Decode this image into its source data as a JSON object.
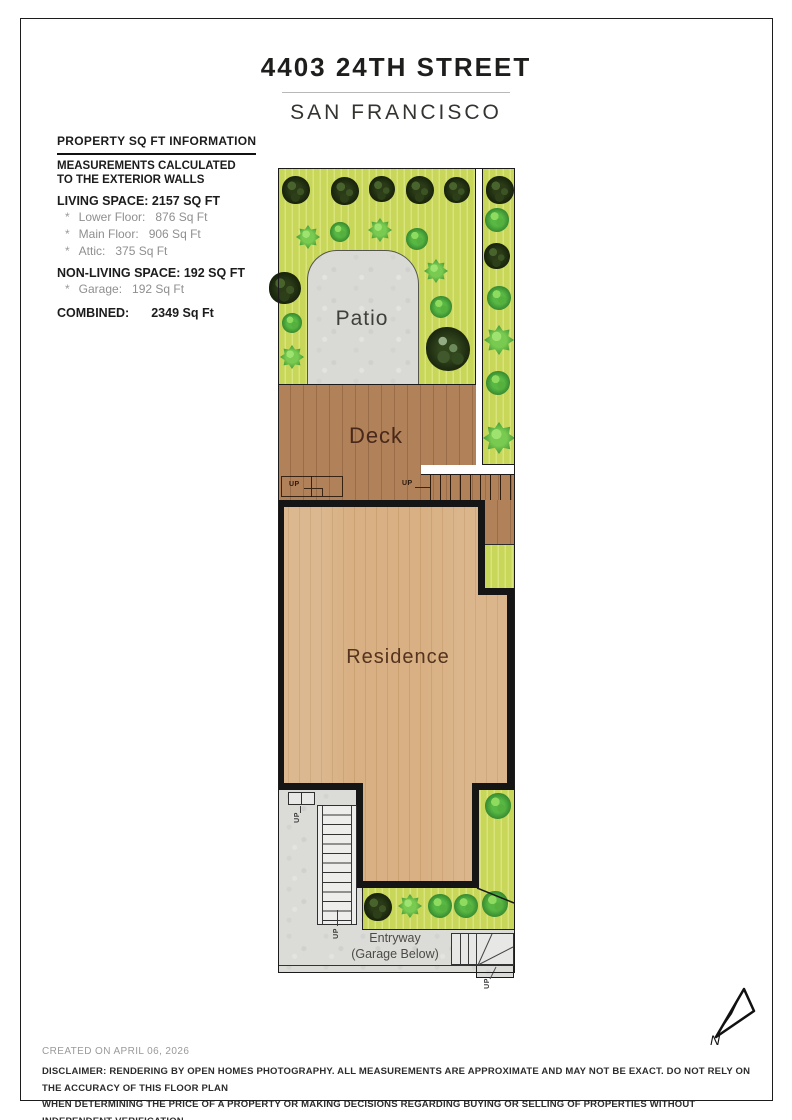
{
  "header": {
    "title": "4403 24TH STREET",
    "subtitle": "SAN FRANCISCO"
  },
  "info_panel": {
    "heading": "PROPERTY SQ FT INFORMATION",
    "note_line1": "MEASUREMENTS CALCULATED",
    "note_line2": "TO THE EXTERIOR WALLS",
    "living_heading": "LIVING SPACE: 2157 SQ FT",
    "living_items": [
      {
        "bullet": "*",
        "label": "Lower Floor:",
        "value": "876 Sq Ft"
      },
      {
        "bullet": "*",
        "label": "Main Floor:",
        "value": "906 Sq Ft"
      },
      {
        "bullet": "*",
        "label": "Attic:",
        "value": "375 Sq Ft"
      }
    ],
    "non_living_heading": "NON-LIVING SPACE: 192 SQ FT",
    "non_living_items": [
      {
        "bullet": "*",
        "label": "Garage:",
        "value": "192 Sq Ft"
      }
    ],
    "combined_label": "COMBINED:",
    "combined_value": "2349 Sq Ft"
  },
  "floor_plan": {
    "labels": {
      "patio": "Patio",
      "deck": "Deck",
      "residence": "Residence",
      "entryway_line1": "Entryway",
      "entryway_line2": "(Garage Below)",
      "up": "UP"
    },
    "compass": {
      "north_label": "N"
    },
    "areas": [
      "Patio",
      "Deck",
      "Residence",
      "Entryway (Garage Below)"
    ]
  },
  "footer": {
    "created": "CREATED ON APRIL 06, 2026",
    "disclaimer_line1": "DISCLAIMER: RENDERING BY OPEN HOMES PHOTOGRAPHY. ALL MEASUREMENTS ARE APPROXIMATE AND MAY NOT BE EXACT. DO NOT RELY ON THE ACCURACY OF THIS FLOOR PLAN",
    "disclaimer_line2": "WHEN DETERMINING THE PRICE OF A PROPERTY OR MAKING DECISIONS REGARDING BUYING OR SELLING OF PROPERTIES WITHOUT INDEPENDENT VERIFICATION."
  },
  "colors": {
    "garden_green": "#c8d65a",
    "garden_stripe": "#d9e47a",
    "deck_brown": "#ad7d55",
    "floor_tan": "#d4ac7e",
    "wall_black": "#151515",
    "concrete_gray": "#dbdbd8",
    "tree_dark": "#2b3b17",
    "bush_bright": "#58b843"
  }
}
